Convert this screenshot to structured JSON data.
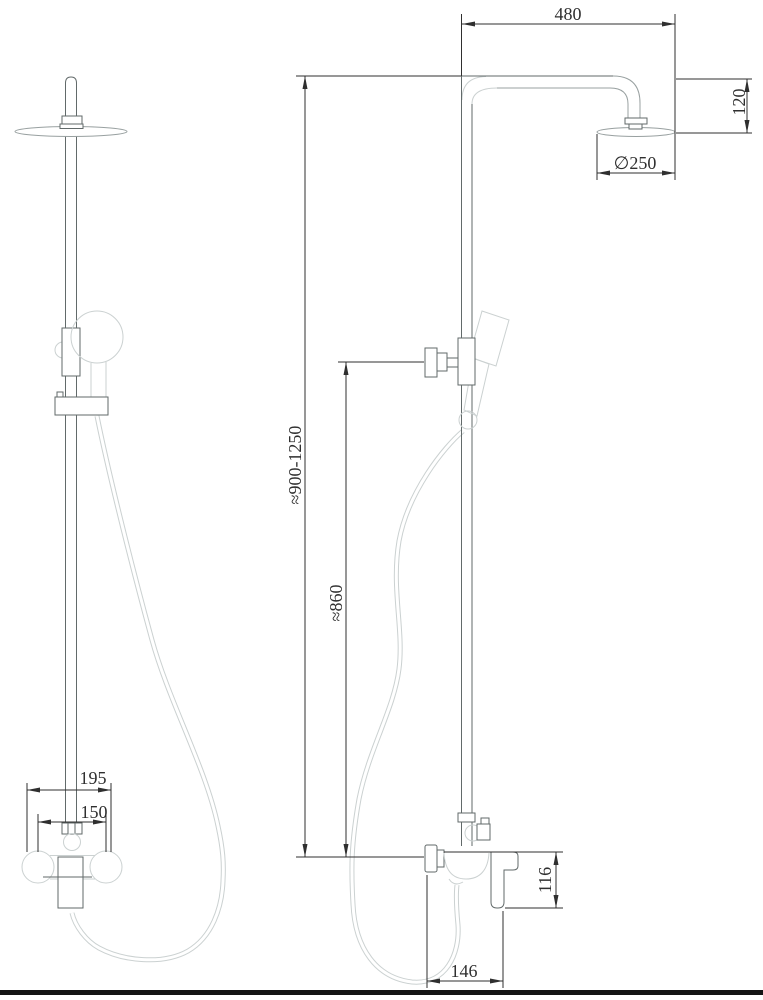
{
  "drawing": {
    "subject": "shower-column-dimension-drawing",
    "views": [
      "front",
      "side"
    ],
    "dimensions": {
      "arm_length": "480",
      "head_drop": "120",
      "head_diameter": "∅250",
      "overall_height": "≈900-1250",
      "rail_height": "≈860",
      "mixer_width_total": "195",
      "mixer_connection_centers": "150",
      "mixer_body_height": "116",
      "mixer_body_depth": "146"
    },
    "colors": {
      "dimension_lines": "#2f2f2f",
      "fixture_lines": "#626a6a",
      "pipe_lines": "#98a0a0",
      "hose_lines": "#cbd1d1",
      "ground_bar": "#141414",
      "background": "#ffffff"
    }
  }
}
